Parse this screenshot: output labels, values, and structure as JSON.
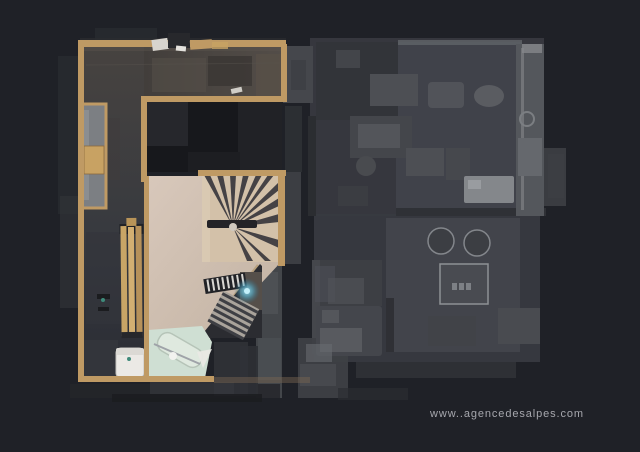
{
  "watermark": {
    "text": "www..agencedesalpes.com"
  },
  "palette": {
    "bg": "#1f2127",
    "wood": "#bf9a64",
    "wood-dark": "#8a6a3f",
    "slate": "#47433f",
    "slate-dark": "#2b2d35",
    "landing": "#cfbfb0",
    "tread": "#d3c1a9",
    "tread-edge": "#3a383d",
    "bath": "#cfdfd3",
    "fixture-white": "#ebe9e5",
    "bench": "#c8a566",
    "inactive": "#383a40",
    "inactive-light": "#54575c",
    "inactive-bright": "#84878b",
    "void": "#17181c",
    "glow": "#6fd0ea",
    "watermark-color": "#b5b6bc"
  },
  "regions": [
    {
      "name": "active-floor-plan",
      "kind": "scanned floor, top-down"
    },
    {
      "name": "main-room"
    },
    {
      "name": "hallway"
    },
    {
      "name": "spiral-staircase"
    },
    {
      "name": "staircase-down"
    },
    {
      "name": "landing"
    },
    {
      "name": "bathroom"
    },
    {
      "name": "wc-toilet"
    },
    {
      "name": "bench"
    },
    {
      "name": "inactive-floor-plan",
      "kind": "ghosted adjacent floor"
    }
  ]
}
